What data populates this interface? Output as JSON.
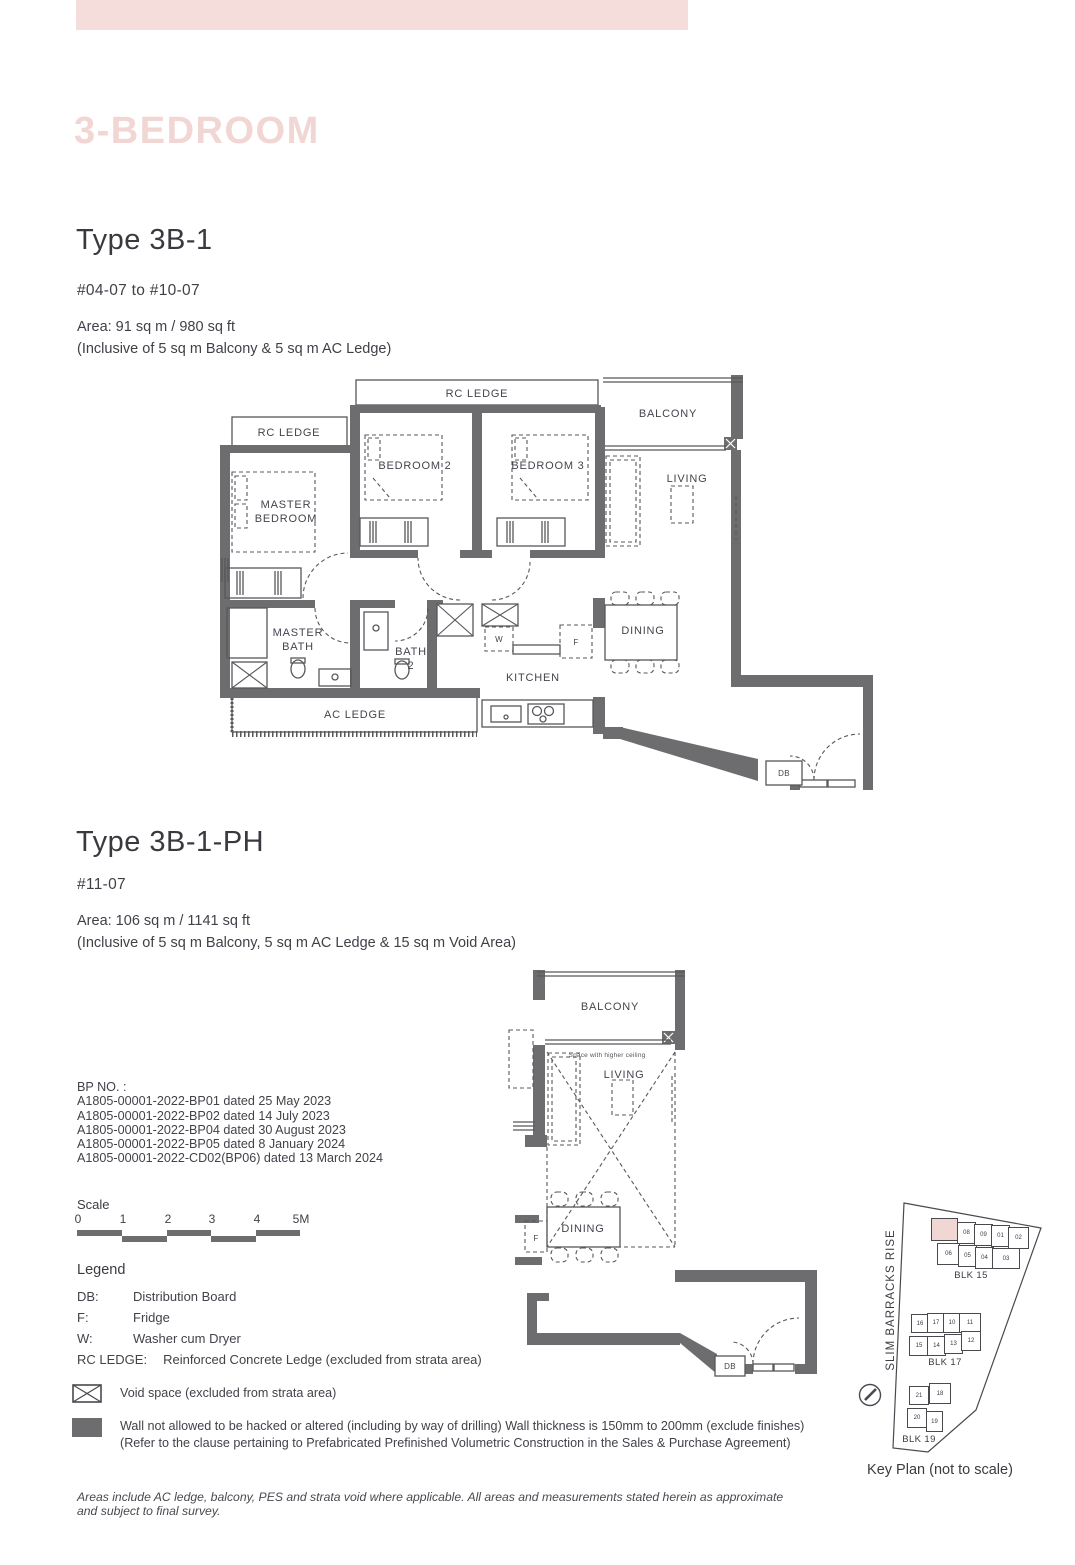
{
  "page": {
    "section_title": "3-BEDROOM",
    "footer_note": "Areas include AC ledge, balcony, PES and strata void where applicable. All areas and measurements stated herein as approximate and subject to final survey."
  },
  "colors": {
    "accent_pink": "#f4dddb",
    "title_pink": "#f1d6d3",
    "wall_gray": "#6d6d6f",
    "keyplan_highlight": "#f0d7d4"
  },
  "unit1": {
    "type_title": "Type 3B-1",
    "levels": "#04-07 to #10-07",
    "area_line1": "Area: 91 sq m / 980 sq ft",
    "area_line2": "(Inclusive of 5 sq m Balcony & 5 sq m AC Ledge)",
    "labels": {
      "rc_ledge_top": "RC LEDGE",
      "rc_ledge_left": "RC LEDGE",
      "balcony": "BALCONY",
      "bedroom2": "BEDROOM 2",
      "bedroom3": "BEDROOM 3",
      "living": "LIVING",
      "master_l1": "MASTER",
      "master_l2": "BEDROOM",
      "mbath_l1": "MASTER",
      "mbath_l2": "BATH",
      "bath2_l1": "BATH",
      "bath2_l2": "2",
      "kitchen": "KITCHEN",
      "dining": "DINING",
      "ac_ledge": "AC LEDGE",
      "db": "DB",
      "washer": "W",
      "fridge": "F"
    }
  },
  "unit2": {
    "type_title": "Type 3B-1-PH",
    "levels": "#11-07",
    "area_line1": "Area: 106 sq m / 1141 sq ft",
    "area_line2": "(Inclusive of 5 sq m Balcony, 5 sq m AC Ledge & 15 sq m Void Area)",
    "labels": {
      "balcony": "BALCONY",
      "ceiling_note": "Space with higher ceiling",
      "living": "LIVING",
      "dining": "DINING",
      "fridge": "F",
      "db": "DB"
    }
  },
  "bp": {
    "heading": "BP NO. :",
    "items": [
      "A1805-00001-2022-BP01 dated 25 May 2023",
      "A1805-00001-2022-BP02 dated 14 July 2023",
      "A1805-00001-2022-BP04 dated 30 August 2023",
      "A1805-00001-2022-BP05 dated 8 January 2024",
      "A1805-00001-2022-CD02(BP06) dated 13 March 2024"
    ]
  },
  "scale": {
    "label": "Scale",
    "ticks": [
      "0",
      "1",
      "2",
      "3",
      "4",
      "5M"
    ]
  },
  "legend": {
    "heading": "Legend",
    "items": [
      {
        "key": "DB:",
        "value": "Distribution Board"
      },
      {
        "key": "F:",
        "value": "Fridge"
      },
      {
        "key": "W:",
        "value": "Washer cum Dryer"
      },
      {
        "key": "RC LEDGE:",
        "value": "Reinforced Concrete Ledge (excluded from strata area)"
      }
    ],
    "void_note": "Void space (excluded from strata area)",
    "wall_note_line1": "Wall not allowed to be hacked or altered (including by way of drilling) Wall thickness is 150mm to 200mm (exclude finishes)",
    "wall_note_line2": "(Refer to the clause pertaining to Prefabricated Prefinished Volumetric Construction in the Sales & Purchase Agreement)"
  },
  "keyplan": {
    "street": "SLIM BARRACKS RISE",
    "caption": "Key Plan (not to scale)",
    "blk15": {
      "label": "BLK 15",
      "row1": [
        "08",
        "09",
        "01",
        "02"
      ],
      "row2": [
        "06",
        "05",
        "04",
        "03"
      ]
    },
    "blk17": {
      "label": "BLK 17",
      "row1": [
        "16",
        "17",
        "10",
        "11"
      ],
      "row2": [
        "15",
        "14",
        "13",
        "12"
      ]
    },
    "blk19": {
      "label": "BLK 19",
      "row1": [
        "21",
        "18"
      ],
      "row2": [
        "20",
        "19"
      ]
    }
  }
}
